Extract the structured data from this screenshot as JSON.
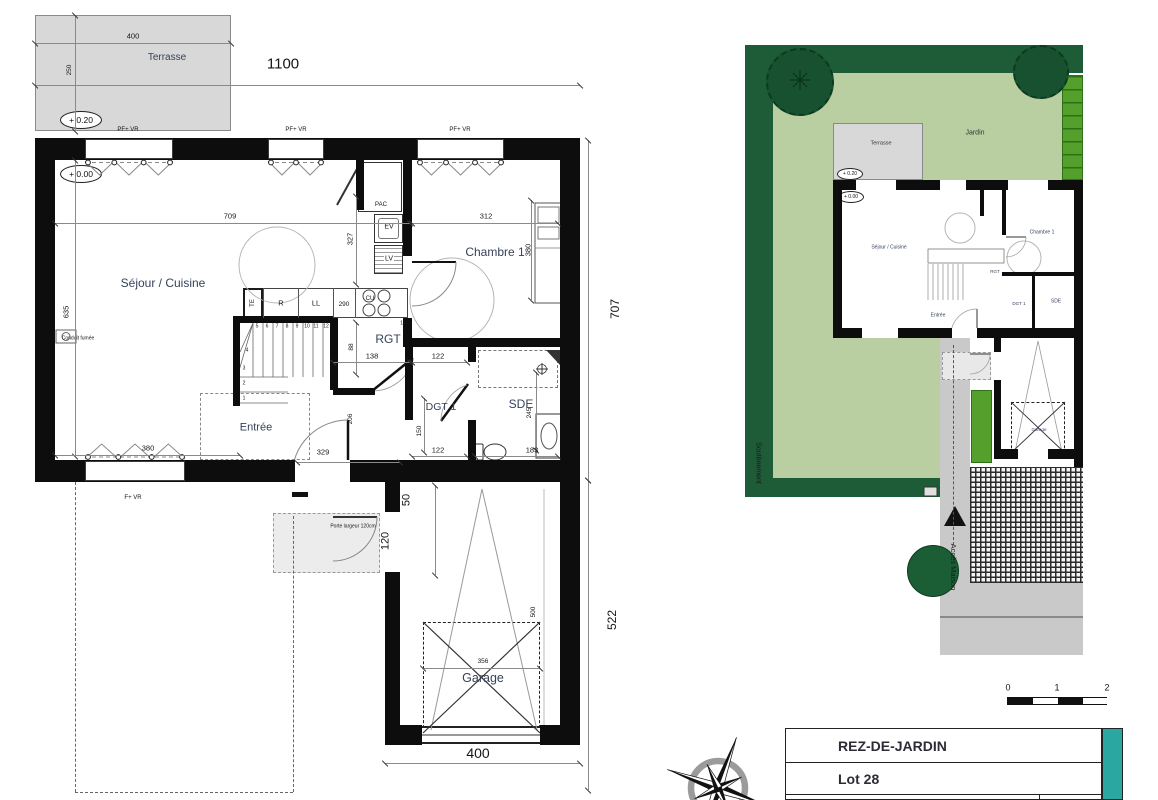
{
  "colors": {
    "wall": "#0d0d0d",
    "terrace_grey": "#d8d8d8",
    "garden_light": "#b9cfa2",
    "garden_dark": "#1d5c37",
    "hedge_bright": "#55a02c",
    "tree": "#175130",
    "path_grey": "#c9c9c9",
    "teal_accent": "#2ba7a2"
  },
  "main_plan": {
    "rooms": {
      "terrasse": "Terrasse",
      "sejour": "Séjour / Cuisine",
      "chambre": "Chambre 1",
      "rgt": "RGT",
      "dgt": "DGT 1",
      "sde": "SDE",
      "entree": "Entrée",
      "garage": "Garage"
    },
    "levels": {
      "upper": "+ 0.20",
      "lower": "+ 0.00"
    },
    "fixtures": {
      "pac": "PAC",
      "ev": "EV",
      "lv": "LV",
      "te": "TE",
      "fridge": "R",
      "washer": "LL",
      "cooktop": "CU"
    },
    "notes": {
      "conduit": "Conduit fumée",
      "garde_corps": "garde corps",
      "porte_garage": "Porte largeur 120cm",
      "window_top": "PF+ VR",
      "window_bottom": "F+ VR"
    },
    "dimensions": [
      {
        "t": "400",
        "x": 133,
        "y": 36
      },
      {
        "t": "250",
        "x": 70,
        "y": 70,
        "r": 1,
        "s": 6.5
      },
      {
        "t": "1100",
        "x": 283,
        "y": 64,
        "s": 15
      },
      {
        "t": "709",
        "x": 230,
        "y": 216
      },
      {
        "t": "312",
        "x": 486,
        "y": 216
      },
      {
        "t": "327",
        "x": 350,
        "y": 239,
        "r": 1
      },
      {
        "t": "380",
        "x": 528,
        "y": 250,
        "r": 1
      },
      {
        "t": "635",
        "x": 66,
        "y": 312,
        "r": 1
      },
      {
        "t": "290",
        "x": 344,
        "y": 305,
        "s": 6.5
      },
      {
        "t": "138",
        "x": 372,
        "y": 356
      },
      {
        "t": "122",
        "x": 438,
        "y": 356
      },
      {
        "t": "88",
        "x": 352,
        "y": 347,
        "r": 1,
        "s": 6.5
      },
      {
        "t": "150",
        "x": 420,
        "y": 431,
        "r": 1,
        "s": 6.5
      },
      {
        "t": "122",
        "x": 438,
        "y": 450
      },
      {
        "t": "183",
        "x": 532,
        "y": 450
      },
      {
        "t": "245",
        "x": 530,
        "y": 413,
        "r": 1,
        "s": 6.5
      },
      {
        "t": "206",
        "x": 351,
        "y": 419,
        "r": 1,
        "s": 6.5
      },
      {
        "t": "329",
        "x": 323,
        "y": 452
      },
      {
        "t": "380",
        "x": 148,
        "y": 448
      },
      {
        "t": "50",
        "x": 407,
        "y": 500,
        "r": 1,
        "s": 11
      },
      {
        "t": "120",
        "x": 386,
        "y": 541,
        "r": 1,
        "s": 11
      },
      {
        "t": "356",
        "x": 483,
        "y": 662,
        "s": 6.5
      },
      {
        "t": "500",
        "x": 534,
        "y": 612,
        "r": 1,
        "s": 6.5
      },
      {
        "t": "400",
        "x": 478,
        "y": 753,
        "s": 14
      },
      {
        "t": "707",
        "x": 615,
        "y": 309,
        "r": 1,
        "s": 12
      },
      {
        "t": "522",
        "x": 612,
        "y": 620,
        "r": 1,
        "s": 12
      }
    ],
    "stair_numbers": [
      {
        "t": "1",
        "x": 244,
        "y": 399
      },
      {
        "t": "2",
        "x": 244,
        "y": 384
      },
      {
        "t": "3",
        "x": 244,
        "y": 369
      },
      {
        "t": "4",
        "x": 247,
        "y": 351
      },
      {
        "t": "5",
        "x": 257,
        "y": 327
      },
      {
        "t": "6",
        "x": 267,
        "y": 327
      },
      {
        "t": "7",
        "x": 277,
        "y": 327
      },
      {
        "t": "8",
        "x": 287,
        "y": 327
      },
      {
        "t": "9",
        "x": 297,
        "y": 327
      },
      {
        "t": "10",
        "x": 307,
        "y": 327
      },
      {
        "t": "11",
        "x": 316,
        "y": 327
      },
      {
        "t": "12",
        "x": 326,
        "y": 327
      },
      {
        "t": "15",
        "x": 403,
        "y": 324
      }
    ]
  },
  "site_plan": {
    "labels": {
      "jardin": "Jardin",
      "terrasse": "Terrasse",
      "soutenement": "Soutènement",
      "acces": "Accès Maison"
    },
    "levels": {
      "upper": "+ 0.20",
      "lower": "+ 0.00"
    },
    "rooms": {
      "sejour": "Séjour / Cuisine",
      "chambre": "Chambre 1",
      "entree": "Entrée",
      "rgt": "RGT",
      "dgt": "DGT 1",
      "sde": "SDE",
      "garage": "Garage"
    }
  },
  "scale_bar": {
    "ticks": [
      "0",
      "1",
      "2"
    ]
  },
  "title_block": {
    "floor": "REZ-DE-JARDIN",
    "lot": "Lot 28"
  }
}
